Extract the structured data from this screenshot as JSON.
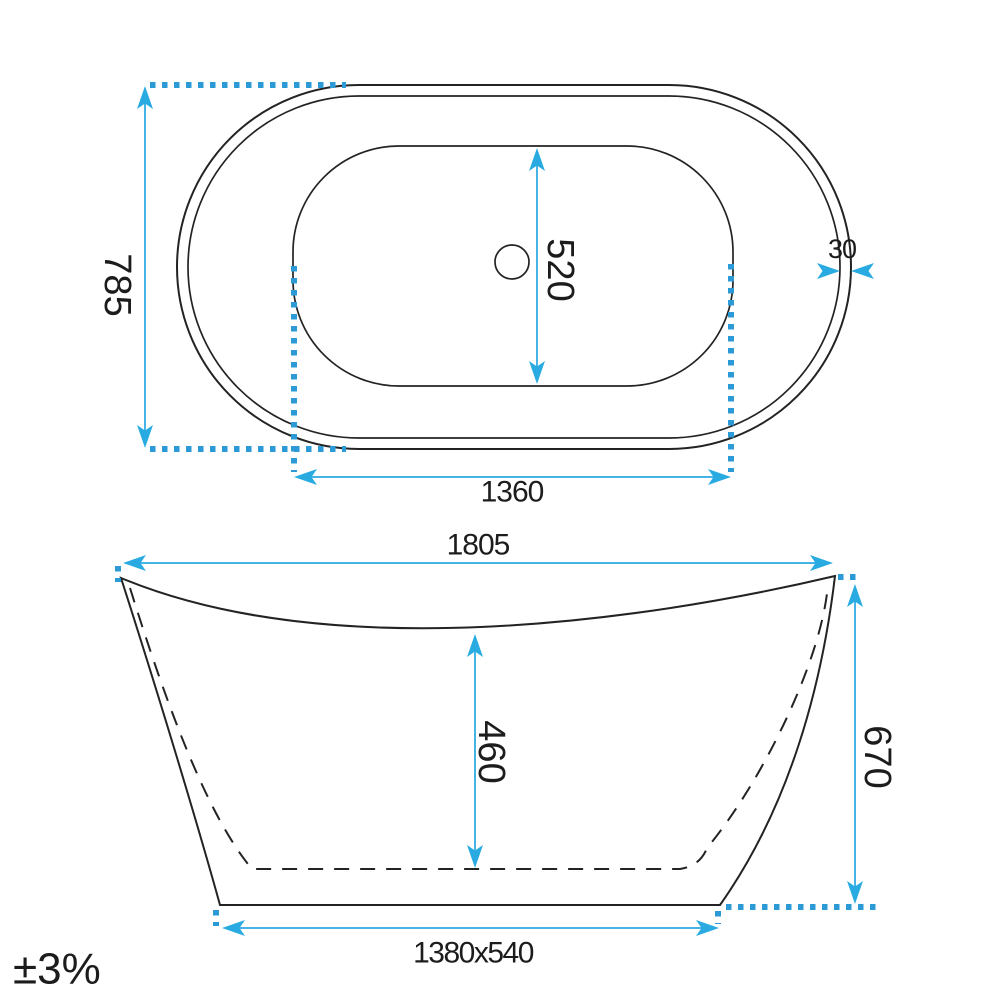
{
  "tolerance_note": "±3%",
  "top_view": {
    "overall_width": "785",
    "basin_width": "520",
    "rim_thickness": "30",
    "basin_length": "1360"
  },
  "side_view": {
    "overall_length": "1805",
    "basin_depth": "460",
    "overall_height": "670",
    "base_size": "1380x540"
  },
  "colors": {
    "dimension_accent": "#29ABE2",
    "dimension_line": "#45B3E5",
    "dotted_line": "#2B9AD6",
    "outline": "#232323",
    "label_text": "#1C1C1C",
    "background": "#FFFFFF"
  }
}
